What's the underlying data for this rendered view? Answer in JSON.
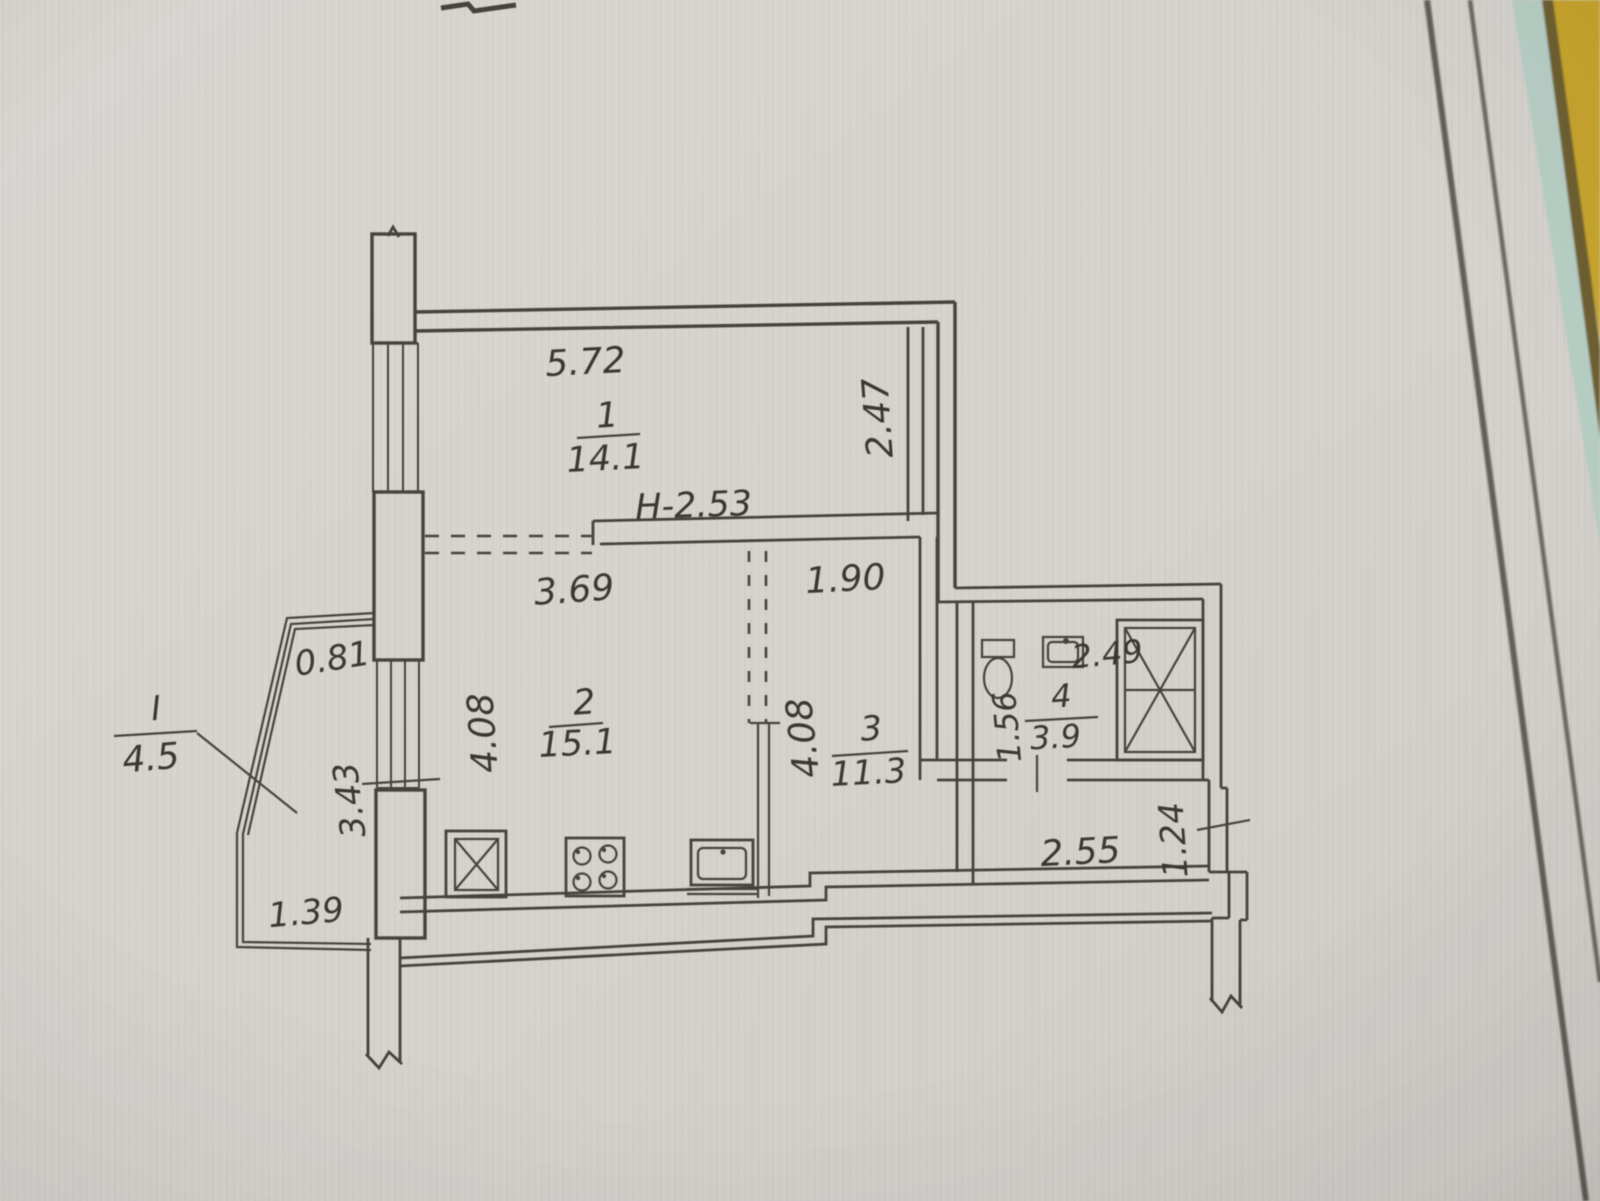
{
  "plan": {
    "ceiling_height_label": "H-2.53",
    "rooms": [
      {
        "key": "room-1",
        "number": "1",
        "area": "14.1",
        "width": "5.72",
        "depth": "2.47"
      },
      {
        "key": "room-2",
        "number": "2",
        "area": "15.1",
        "width": "3.69",
        "depth": "4.08"
      },
      {
        "key": "room-3",
        "number": "3",
        "area": "11.3",
        "width": "1.90",
        "depth": "4.08"
      },
      {
        "key": "room-4",
        "number": "4",
        "area": "3.9",
        "width": "2.49",
        "depth": "1.56"
      },
      {
        "key": "balcony",
        "number": "I",
        "area": "4.5",
        "dim_top": "0.81",
        "dim_side": "3.43",
        "dim_bottom": "1.39"
      }
    ],
    "hallway": {
      "length": "2.55",
      "width": "1.24"
    }
  },
  "colors": {
    "paper": "#d7d3cf",
    "ink": "#46433e",
    "table_yellow": "#c7a42f",
    "edge_teal": "#b7cec5"
  }
}
